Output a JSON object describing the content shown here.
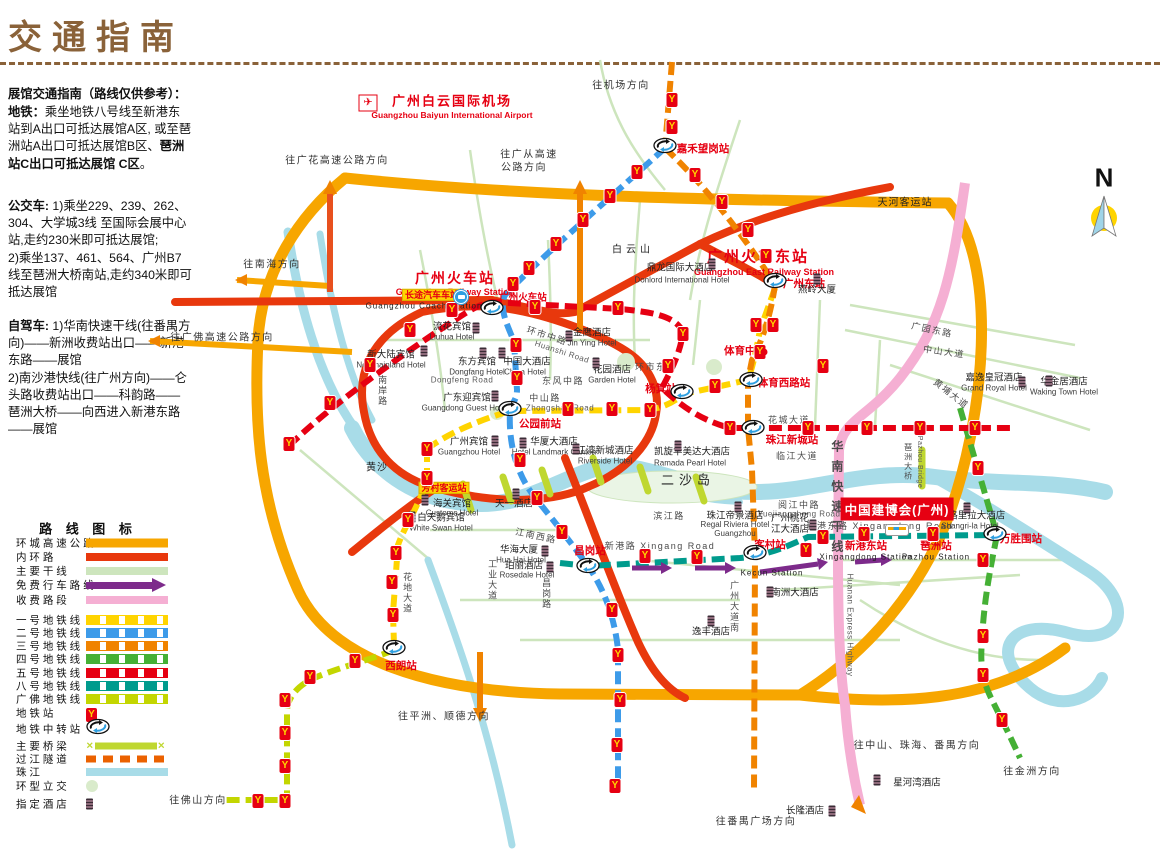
{
  "page": {
    "title": "交通指南"
  },
  "colors": {
    "ring_expressway": "#f7a600",
    "inner_ring": "#e8380d",
    "main_road": "#cde5bd",
    "free_route": "#7d2b8b",
    "toll_road": "#f5afd3",
    "line1": "#ffd400",
    "line2": "#3d9be9",
    "line3": "#f08300",
    "line4": "#45b035",
    "line5": "#e60012",
    "line8": "#009b8d",
    "guangfo": "#c3d600",
    "bridge": "#bfd730",
    "tunnel": "#eb6100",
    "river": "#a8dce8",
    "roundabout": "#d9ebcb",
    "station_red": "#e60012",
    "title_brown": "#8a6239"
  },
  "sidebar": {
    "paragraphs": [
      {
        "top": 86,
        "segments": [
          {
            "t": "展馆交通指南（路线仅供参考）：",
            "b": true
          }
        ]
      },
      {
        "top": 104,
        "segments": [
          {
            "t": "地铁：",
            "b": true
          },
          {
            "t": "乘坐地铁八号线至新港东站到A出口可抵达展馆A区, 或至琶洲站A出口可抵达展馆B区、",
            "b": false
          },
          {
            "t": "琶洲站C出口可抵达展馆 C区",
            "b": true
          },
          {
            "t": "。",
            "b": false
          }
        ]
      },
      {
        "top": 198,
        "segments": [
          {
            "t": "公交车: ",
            "b": true
          },
          {
            "t": "1)乘坐229、239、262、304、大学城3线 至国际会展中心站,走约230米即可抵达展馆;\n2)乘坐137、461、564、广州B7线至琶洲大桥南站,走约340米即可抵达展馆",
            "b": false
          }
        ]
      },
      {
        "top": 318,
        "segments": [
          {
            "t": "自驾车: ",
            "b": true
          },
          {
            "t": "1)华南快速干线(往番禺方向)——新洲收费站出口——新港东路——展馆\n 2)南沙港快线(往广州方向)——仑头路收费站出口——科韵路——琶洲大桥——向西进入新港东路——展馆",
            "b": false
          }
        ]
      }
    ]
  },
  "legend": {
    "title": "路 线 图 标",
    "title_x": 88,
    "title_y": 528,
    "items": [
      {
        "label": "环 城 高 速 公 路",
        "type": "solid",
        "color": "#f7a600",
        "y": 543,
        "h": 9
      },
      {
        "label": "内 环 路",
        "type": "solid",
        "color": "#e8380d",
        "y": 557,
        "h": 8
      },
      {
        "label": "主 要 干 线",
        "type": "solid",
        "color": "#cde5bd",
        "y": 571,
        "h": 8
      },
      {
        "label": "免 费 行 车 路 线",
        "type": "arrow",
        "color": "#7d2b8b",
        "y": 585
      },
      {
        "label": "收 费 路 段",
        "type": "solid",
        "color": "#f5afd3",
        "y": 600,
        "h": 8
      },
      {
        "label": "一 号 地 铁 线",
        "type": "metro",
        "color": "#ffd400",
        "y": 620
      },
      {
        "label": "二 号 地 铁 线",
        "type": "metro",
        "color": "#3d9be9",
        "y": 633
      },
      {
        "label": "三 号 地 铁 线",
        "type": "metro",
        "color": "#f08300",
        "y": 646
      },
      {
        "label": "四 号 地 铁 线",
        "type": "metro",
        "color": "#45b035",
        "y": 659
      },
      {
        "label": "五 号 地 铁 线",
        "type": "metro",
        "color": "#e60012",
        "y": 673
      },
      {
        "label": "八 号 地 铁 线",
        "type": "metro",
        "color": "#009b8d",
        "y": 686
      },
      {
        "label": "广 佛 地 铁 线",
        "type": "metro",
        "color": "#c3d600",
        "y": 699
      },
      {
        "label": "地 铁 站",
        "type": "station",
        "color": "#e60012",
        "y": 713
      },
      {
        "label": "地 铁 中 转 站",
        "type": "transfer",
        "color": "#2e9fe0",
        "y": 729
      },
      {
        "label": "主 要 桥 梁",
        "type": "bridge",
        "color": "#bfd730",
        "y": 746
      },
      {
        "label": "过 江 隧 道",
        "type": "tunnel",
        "color": "#eb6100",
        "y": 759
      },
      {
        "label": "珠 江",
        "type": "solid",
        "color": "#a8dce8",
        "y": 772,
        "h": 8
      },
      {
        "label": "环 型 立 交",
        "type": "circle",
        "color": "#d9ebcb",
        "y": 786
      },
      {
        "label": "指 定 酒 店",
        "type": "hotel",
        "color": "#3a2b36",
        "y": 804
      }
    ]
  },
  "map": {
    "metro_icon_glyph": "Y",
    "compass": {
      "letter": "N",
      "x": 1104,
      "y": 178
    },
    "airport": {
      "t": "广州白云国际机场",
      "en": "Guangzhou Baiyun International Airport",
      "x": 452,
      "y": 102,
      "ex": 452,
      "ey": 116,
      "ix": 368,
      "iy": 103,
      "glyph": "✈"
    },
    "expo": {
      "t": "中国建博会(广州)",
      "x": 897,
      "y": 509
    },
    "big_stations": [
      {
        "t": "广州火车站",
        "x": 455,
        "y": 278,
        "fs": 14,
        "en": "Guangzhou Railway Station",
        "ex": 455,
        "ey": 292
      },
      {
        "t": "广州火车东站",
        "x": 758,
        "y": 257,
        "fs": 15,
        "en": "Guangzhou East Railway Station",
        "ex": 764,
        "ey": 272
      }
    ],
    "station_labels": [
      {
        "t": "嘉禾望岗站",
        "x": 703,
        "y": 149
      },
      {
        "t": "广州火车站",
        "x": 523,
        "y": 299,
        "fs": 9.5
      },
      {
        "t": "广州东站",
        "x": 804,
        "y": 284
      },
      {
        "t": "体育西路站",
        "x": 784,
        "y": 383
      },
      {
        "t": "珠江新城站",
        "x": 792,
        "y": 440
      },
      {
        "t": "杨箕站",
        "x": 661,
        "y": 389
      },
      {
        "t": "公园前站",
        "x": 540,
        "y": 424
      },
      {
        "t": "昌岗站",
        "x": 590,
        "y": 551
      },
      {
        "t": "客村站",
        "x": 770,
        "y": 545
      },
      {
        "t": "新港东站",
        "x": 866,
        "y": 546
      },
      {
        "t": "琶洲站",
        "x": 936,
        "y": 546
      },
      {
        "t": "万胜围站",
        "x": 1021,
        "y": 539
      },
      {
        "t": "西朗站",
        "x": 401,
        "y": 666
      },
      {
        "t": "体育中心",
        "x": 745,
        "y": 351
      }
    ],
    "black_labels": [
      {
        "t": "天河客运站",
        "x": 905,
        "y": 203
      },
      {
        "t": "白云山",
        "x": 633,
        "y": 250,
        "ls": 4
      },
      {
        "t": "二沙岛",
        "x": 688,
        "y": 481,
        "fs": 13,
        "ls": 5
      },
      {
        "t": "黄沙",
        "x": 377,
        "y": 468
      },
      {
        "t": "Kecun Station",
        "x": 772,
        "y": 573,
        "fs": 8
      },
      {
        "t": "Xingangdong Station",
        "x": 866,
        "y": 557,
        "fs": 8
      },
      {
        "t": "Pazhou Station",
        "x": 936,
        "y": 557,
        "fs": 8
      },
      {
        "t": "Guangzhou Coach Station",
        "x": 424,
        "y": 306,
        "fs": 8
      }
    ],
    "yellow_labels": [
      {
        "t": "长途汽车车站",
        "x": 432,
        "y": 295
      },
      {
        "t": "芳村客运站",
        "x": 444,
        "y": 488
      }
    ],
    "hotels": [
      {
        "t": "鼎龙国际大酒店",
        "x": 680,
        "y": 269,
        "en": "Donlord International Hotel",
        "ex": 682,
        "ey": 280,
        "ix": 712,
        "iy": 264
      },
      {
        "t": "燕岭大厦",
        "x": 817,
        "y": 291,
        "ix": 817,
        "iy": 279
      },
      {
        "t": "流花宾馆",
        "x": 452,
        "y": 328,
        "en": "Liuhua Hotel",
        "ex": 452,
        "ey": 337,
        "ix": 476,
        "iy": 328
      },
      {
        "t": "新大陆宾馆",
        "x": 391,
        "y": 356,
        "en": "Newmainland Hotel",
        "ex": 391,
        "ey": 365,
        "ix": 424,
        "iy": 351
      },
      {
        "t": "东方宾馆",
        "x": 477,
        "y": 363,
        "en": "Dongfang Hotel",
        "ex": 477,
        "ey": 372,
        "ix": 483,
        "iy": 353
      },
      {
        "t": "中国大酒店",
        "x": 527,
        "y": 363,
        "en": "China Hotel",
        "ex": 525,
        "ey": 372,
        "ix": 502,
        "iy": 353
      },
      {
        "t": "金鹰酒店",
        "x": 592,
        "y": 334,
        "en": "Jin Ying Hotel",
        "ex": 592,
        "ey": 343,
        "ix": 569,
        "iy": 336
      },
      {
        "t": "花园酒店",
        "x": 612,
        "y": 371,
        "en": "Garden Hotel",
        "ex": 612,
        "ey": 380,
        "ix": 596,
        "iy": 363
      },
      {
        "t": "广东迎宾馆",
        "x": 467,
        "y": 399,
        "en": "Guangdong Guest House",
        "ex": 467,
        "ey": 408,
        "ix": 495,
        "iy": 396
      },
      {
        "t": "广州宾馆",
        "x": 469,
        "y": 443,
        "en": "Guangzhou Hotel",
        "ex": 469,
        "ey": 452,
        "ix": 495,
        "iy": 441
      },
      {
        "t": "华厦大酒店",
        "x": 554,
        "y": 443,
        "en": "Hotel Landmark Canton",
        "ex": 554,
        "ey": 452,
        "ix": 523,
        "iy": 443
      },
      {
        "t": "江湾新城酒店",
        "x": 605,
        "y": 452,
        "en": "Riverside Hotel",
        "ex": 605,
        "ey": 461,
        "ix": 576,
        "iy": 449
      },
      {
        "t": "凯旋华美达大酒店",
        "x": 692,
        "y": 453,
        "en": "Ramada Pearl Hotel",
        "ex": 690,
        "ey": 463,
        "ix": 678,
        "iy": 446
      },
      {
        "t": "嘉逸皇冠酒店",
        "x": 994,
        "y": 379,
        "en": "Grand Royal Hotel",
        "ex": 994,
        "ey": 388,
        "ix": 1022,
        "iy": 382
      },
      {
        "t": "华金居酒店",
        "x": 1064,
        "y": 383,
        "en": "Waking Town Hotel",
        "ex": 1064,
        "ey": 392,
        "ix": 1049,
        "iy": 381
      },
      {
        "t": "海关宾馆",
        "x": 452,
        "y": 505,
        "en": "Customs Hotel",
        "ex": 452,
        "ey": 513,
        "ix": 425,
        "iy": 500
      },
      {
        "t": "白天鹅宾馆",
        "x": 441,
        "y": 519,
        "en": "White Swan Hotel",
        "ex": 441,
        "ey": 528,
        "ix": 412,
        "iy": 517
      },
      {
        "t": "天一酒店",
        "x": 514,
        "y": 505,
        "ix": 516,
        "iy": 494
      },
      {
        "t": "华海大厦",
        "x": 519,
        "y": 551,
        "en": "Hua Hai Hotel",
        "ex": 521,
        "ey": 560,
        "ix": 545,
        "iy": 551
      },
      {
        "t": "珀丽酒店",
        "x": 524,
        "y": 567,
        "en": "Rosedale Hotel",
        "ex": 527,
        "ey": 575,
        "ix": 550,
        "iy": 567
      },
      {
        "t": "珠江帝景酒店",
        "x": 735,
        "y": 517,
        "en": "Regal Riviera Hotel\nGuangzhou",
        "ex": 735,
        "ey": 529,
        "ix": 738,
        "iy": 507
      },
      {
        "t": "广州桃花\n江大酒店",
        "x": 790,
        "y": 525,
        "ix": 813,
        "iy": 525
      },
      {
        "t": "香格里拉大酒店",
        "x": 972,
        "y": 517,
        "en": "Shangri-la Hotel",
        "ex": 970,
        "ey": 526,
        "ix": 967,
        "iy": 508
      },
      {
        "t": "南洲大酒店",
        "x": 795,
        "y": 594,
        "ix": 770,
        "iy": 592
      },
      {
        "t": "逸丰酒店",
        "x": 711,
        "y": 633,
        "ix": 711,
        "iy": 621
      },
      {
        "t": "星河湾酒店",
        "x": 917,
        "y": 784,
        "ix": 877,
        "iy": 780
      },
      {
        "t": "长隆酒店",
        "x": 805,
        "y": 812,
        "ix": 832,
        "iy": 811
      }
    ],
    "roads": [
      {
        "t": "环市中路",
        "x": 547,
        "y": 336,
        "r": 18
      },
      {
        "t": "Huanshi Road",
        "x": 562,
        "y": 352,
        "r": 18,
        "en": 1
      },
      {
        "t": "环市东路",
        "x": 656,
        "y": 367
      },
      {
        "t": "东风中路",
        "x": 563,
        "y": 381
      },
      {
        "t": "Dongfeng Road",
        "x": 462,
        "y": 380,
        "en": 1
      },
      {
        "t": "中山路",
        "x": 545,
        "y": 398
      },
      {
        "t": "Zhongshan Road",
        "x": 560,
        "y": 408,
        "en": 1
      },
      {
        "t": "广园东路",
        "x": 932,
        "y": 330,
        "r": 12
      },
      {
        "t": "中山大道",
        "x": 944,
        "y": 352,
        "r": 8
      },
      {
        "t": "黄埔大道",
        "x": 951,
        "y": 394,
        "r": 38
      },
      {
        "t": "花城大道",
        "x": 789,
        "y": 420
      },
      {
        "t": "临江大道",
        "x": 797,
        "y": 456
      },
      {
        "t": "滨江路",
        "x": 669,
        "y": 516
      },
      {
        "t": "新港路 Xingang Road",
        "x": 660,
        "y": 546
      },
      {
        "t": "新港东路 Xingangdong Road",
        "x": 880,
        "y": 526
      },
      {
        "t": "阅江中路",
        "x": 799,
        "y": 505
      },
      {
        "t": "Yuejiangzhong Road",
        "x": 799,
        "y": 514,
        "en": 1
      },
      {
        "t": "江南西路",
        "x": 536,
        "y": 536,
        "r": 12
      },
      {
        "t": "南岸路",
        "x": 382,
        "y": 391,
        "v": 1
      },
      {
        "t": "工业大道",
        "x": 492,
        "y": 580,
        "v": 1
      },
      {
        "t": "昌岗路",
        "x": 546,
        "y": 594,
        "v": 1
      },
      {
        "t": "花地大道",
        "x": 407,
        "y": 593,
        "v": 1
      },
      {
        "t": "广州大道南",
        "x": 734,
        "y": 607,
        "v": 1
      },
      {
        "t": "华南快速干线",
        "x": 836,
        "y": 500,
        "v": 1,
        "fs": 12,
        "b": 1,
        "ls": 8
      },
      {
        "t": "Huanan Express Highway",
        "x": 850,
        "y": 625,
        "v": 1,
        "en": 1
      },
      {
        "t": "琶洲大桥",
        "x": 908,
        "y": 462,
        "v": 1,
        "fs": 8
      },
      {
        "t": "Pazhou Bridge",
        "x": 919,
        "y": 462,
        "v": 1,
        "en": 1,
        "fs": 7
      }
    ],
    "directions": [
      {
        "t": "往机场方向",
        "x": 621,
        "y": 86
      },
      {
        "t": "往广花高速公路方向",
        "x": 337,
        "y": 161
      },
      {
        "t": "往广从高速",
        "x": 529,
        "y": 155
      },
      {
        "t": "公路方向",
        "x": 524,
        "y": 168
      },
      {
        "t": "往南海方向",
        "x": 272,
        "y": 265
      },
      {
        "t": "往广佛高速公路方向",
        "x": 222,
        "y": 338
      },
      {
        "t": "往平洲、顺德方向",
        "x": 444,
        "y": 717
      },
      {
        "t": "往佛山方向",
        "x": 198,
        "y": 801
      },
      {
        "t": "往番禺广场方向",
        "x": 756,
        "y": 822
      },
      {
        "t": "往中山、珠海、番禺方向",
        "x": 917,
        "y": 746
      },
      {
        "t": "往金洲方向",
        "x": 1032,
        "y": 772
      }
    ],
    "metro_icons": [
      [
        672,
        100
      ],
      [
        672,
        127
      ],
      [
        637,
        172
      ],
      [
        610,
        196
      ],
      [
        583,
        220
      ],
      [
        556,
        244
      ],
      [
        529,
        268
      ],
      [
        513,
        284
      ],
      [
        695,
        175
      ],
      [
        722,
        202
      ],
      [
        748,
        230
      ],
      [
        766,
        256
      ],
      [
        756,
        325
      ],
      [
        773,
        325
      ],
      [
        760,
        352
      ],
      [
        289,
        444
      ],
      [
        330,
        403
      ],
      [
        370,
        365
      ],
      [
        410,
        330
      ],
      [
        452,
        310
      ],
      [
        535,
        307
      ],
      [
        618,
        308
      ],
      [
        683,
        334
      ],
      [
        668,
        366
      ],
      [
        730,
        428
      ],
      [
        808,
        428
      ],
      [
        823,
        366
      ],
      [
        867,
        428
      ],
      [
        920,
        428
      ],
      [
        975,
        428
      ],
      [
        516,
        345
      ],
      [
        517,
        378
      ],
      [
        520,
        460
      ],
      [
        537,
        498
      ],
      [
        562,
        532
      ],
      [
        612,
        610
      ],
      [
        618,
        655
      ],
      [
        620,
        700
      ],
      [
        617,
        745
      ],
      [
        615,
        786
      ],
      [
        427,
        449
      ],
      [
        427,
        478
      ],
      [
        408,
        520
      ],
      [
        396,
        553
      ],
      [
        392,
        582
      ],
      [
        393,
        615
      ],
      [
        568,
        409
      ],
      [
        612,
        409
      ],
      [
        650,
        410
      ],
      [
        715,
        386
      ],
      [
        645,
        556
      ],
      [
        697,
        557
      ],
      [
        806,
        550
      ],
      [
        823,
        537
      ],
      [
        864,
        534
      ],
      [
        933,
        534
      ],
      [
        978,
        468
      ],
      [
        983,
        560
      ],
      [
        983,
        636
      ],
      [
        983,
        675
      ],
      [
        1002,
        720
      ],
      [
        355,
        661
      ],
      [
        310,
        677
      ],
      [
        285,
        700
      ],
      [
        285,
        733
      ],
      [
        285,
        766
      ],
      [
        285,
        801
      ],
      [
        258,
        801
      ]
    ],
    "transfer_icons": [
      [
        665,
        148
      ],
      [
        775,
        283
      ],
      [
        492,
        310
      ],
      [
        510,
        411
      ],
      [
        682,
        394
      ],
      [
        751,
        382
      ],
      [
        753,
        430
      ],
      [
        588,
        568
      ],
      [
        755,
        555
      ],
      [
        995,
        536
      ],
      [
        394,
        650
      ]
    ],
    "misc_icons": {
      "coach": [
        461,
        297
      ],
      "bus": [
        897,
        530
      ],
      "stadium_dot": [
        764,
        352
      ]
    }
  }
}
